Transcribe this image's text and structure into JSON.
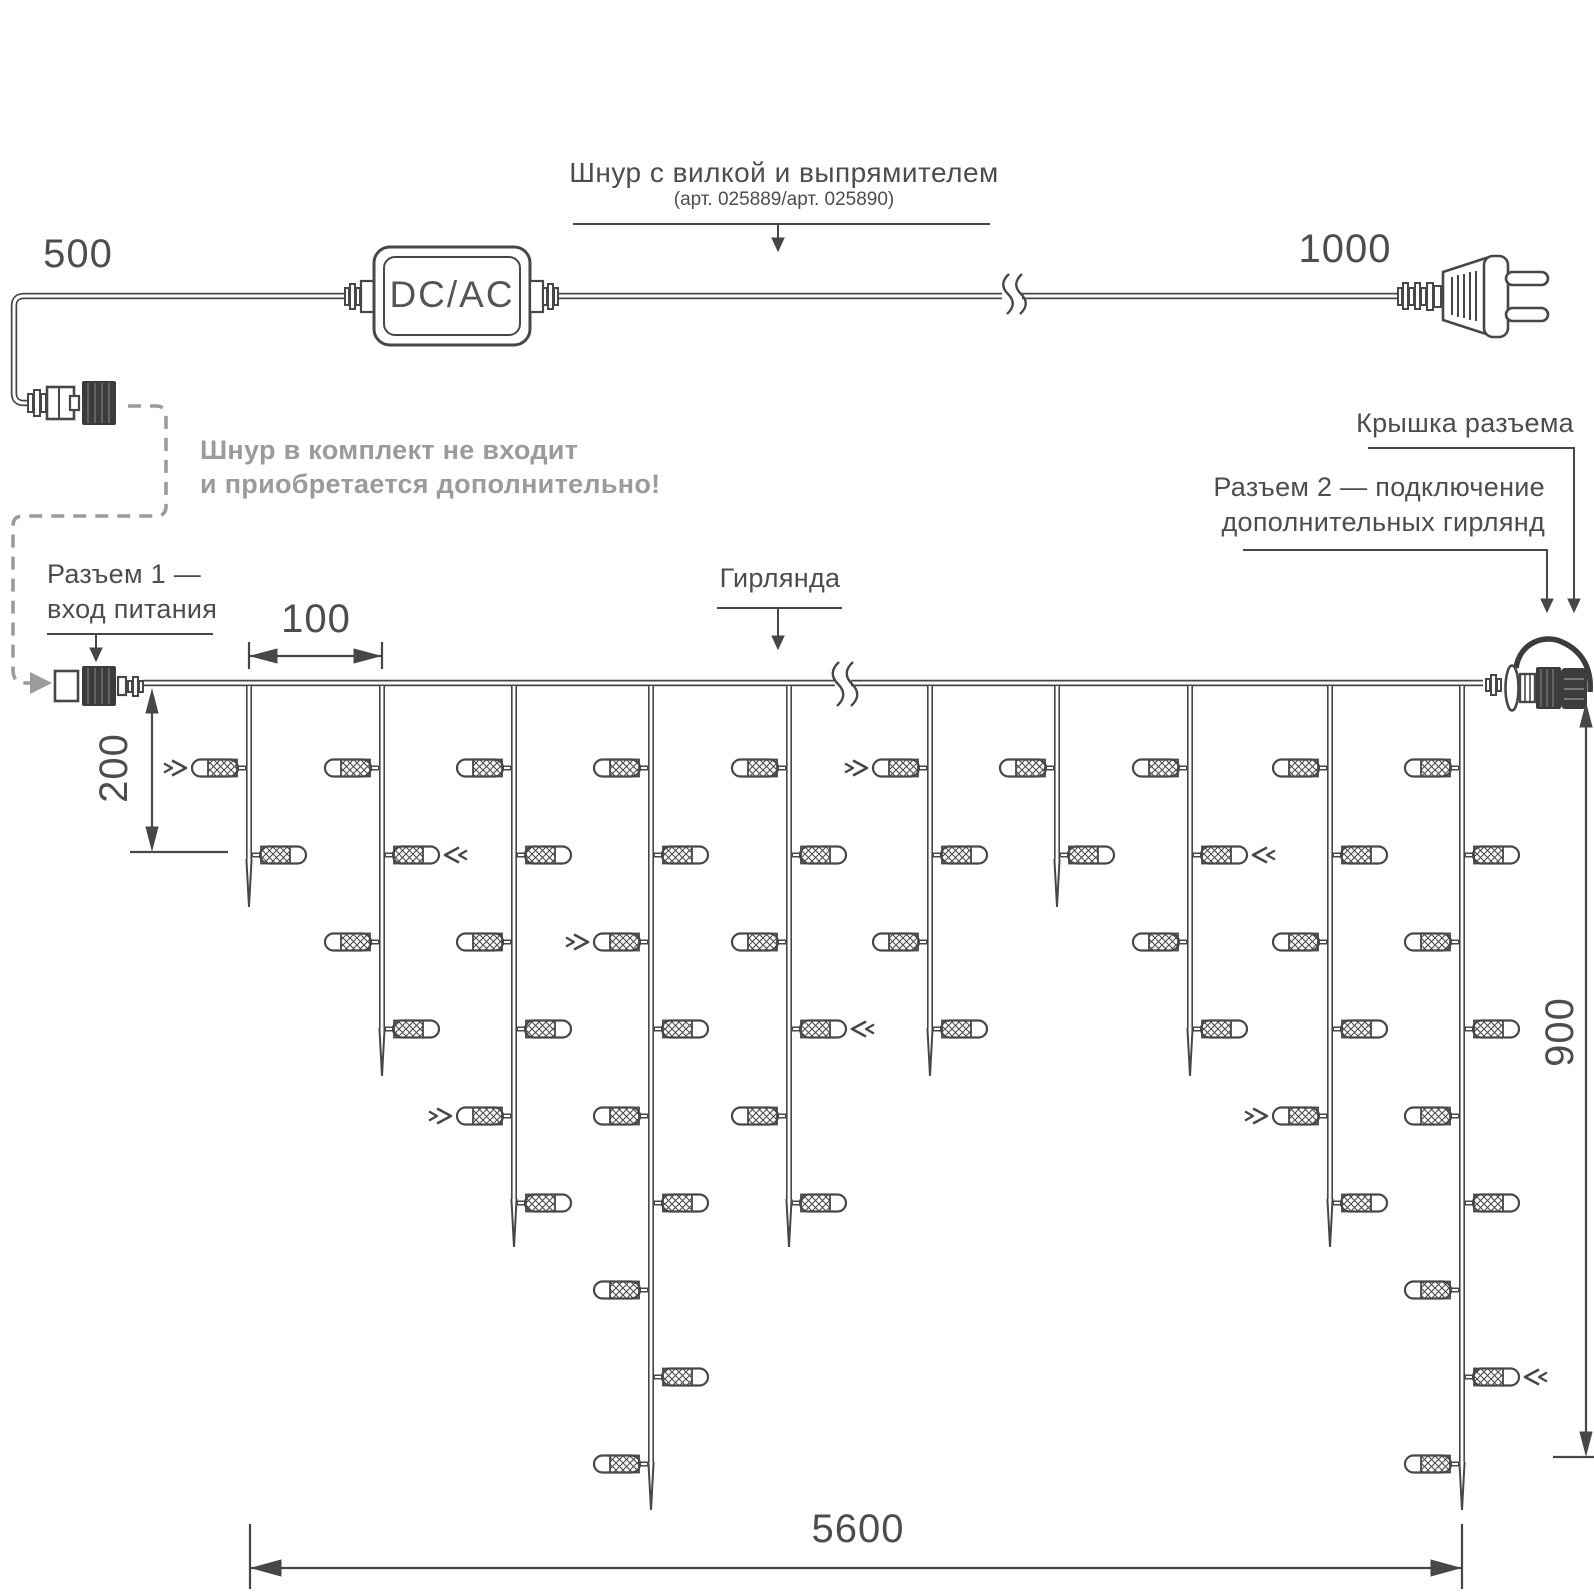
{
  "colors": {
    "line": "#474747",
    "text": "#4d4d4d",
    "muted": "#9b9b9b"
  },
  "header": {
    "title": "Шнур с вилкой и выпрямителем",
    "subtitle": "(арт. 025889/арт. 025890)"
  },
  "labels": {
    "converter": "DC/AC",
    "note_line1": "Шнур в комплект не входит",
    "note_line2": "и приобретается дополнительно!",
    "connector1_line1": "Разъем 1 —",
    "connector1_line2": "вход питания",
    "garland": "Гирлянда",
    "connector_cap": "Крышка разъема",
    "connector2_line1": "Разъем 2 — подключение",
    "connector2_line2": "дополнительных гирлянд"
  },
  "dimensions": {
    "cord_to_connector": "500",
    "cord_to_plug": "1000",
    "drop_spacing": "100",
    "first_bulb_offset": "200",
    "drop_max_length": "900",
    "garland_length": "5600"
  },
  "garland": {
    "wire_y": 683,
    "row_start_y": 768,
    "row_spacing": 87,
    "drops": [
      {
        "x": 249,
        "bulb_count": 2,
        "tip_y": 907,
        "arrow": {
          "row": 1,
          "dir": "right"
        }
      },
      {
        "x": 382,
        "bulb_count": 4,
        "tip_y": 1076,
        "arrow": {
          "row": 2,
          "dir": "left"
        }
      },
      {
        "x": 514,
        "bulb_count": 6,
        "tip_y": 1247,
        "arrow": {
          "row": 5,
          "dir": "right"
        }
      },
      {
        "x": 651,
        "bulb_count": 9,
        "tip_y": 1510,
        "arrow": {
          "row": 3,
          "dir": "right"
        }
      },
      {
        "x": 789,
        "bulb_count": 6,
        "tip_y": 1247,
        "arrow": {
          "row": 4,
          "dir": "left"
        }
      },
      {
        "x": 930,
        "bulb_count": 4,
        "tip_y": 1076,
        "arrow": {
          "row": 1,
          "dir": "right"
        }
      },
      {
        "x": 1057,
        "bulb_count": 2,
        "tip_y": 907,
        "arrow": null
      },
      {
        "x": 1190,
        "bulb_count": 4,
        "tip_y": 1076,
        "arrow": {
          "row": 2,
          "dir": "left"
        }
      },
      {
        "x": 1330,
        "bulb_count": 6,
        "tip_y": 1247,
        "arrow": {
          "row": 5,
          "dir": "right"
        }
      },
      {
        "x": 1462,
        "bulb_count": 9,
        "tip_y": 1510,
        "arrow": {
          "row": 8,
          "dir": "left"
        }
      }
    ]
  }
}
